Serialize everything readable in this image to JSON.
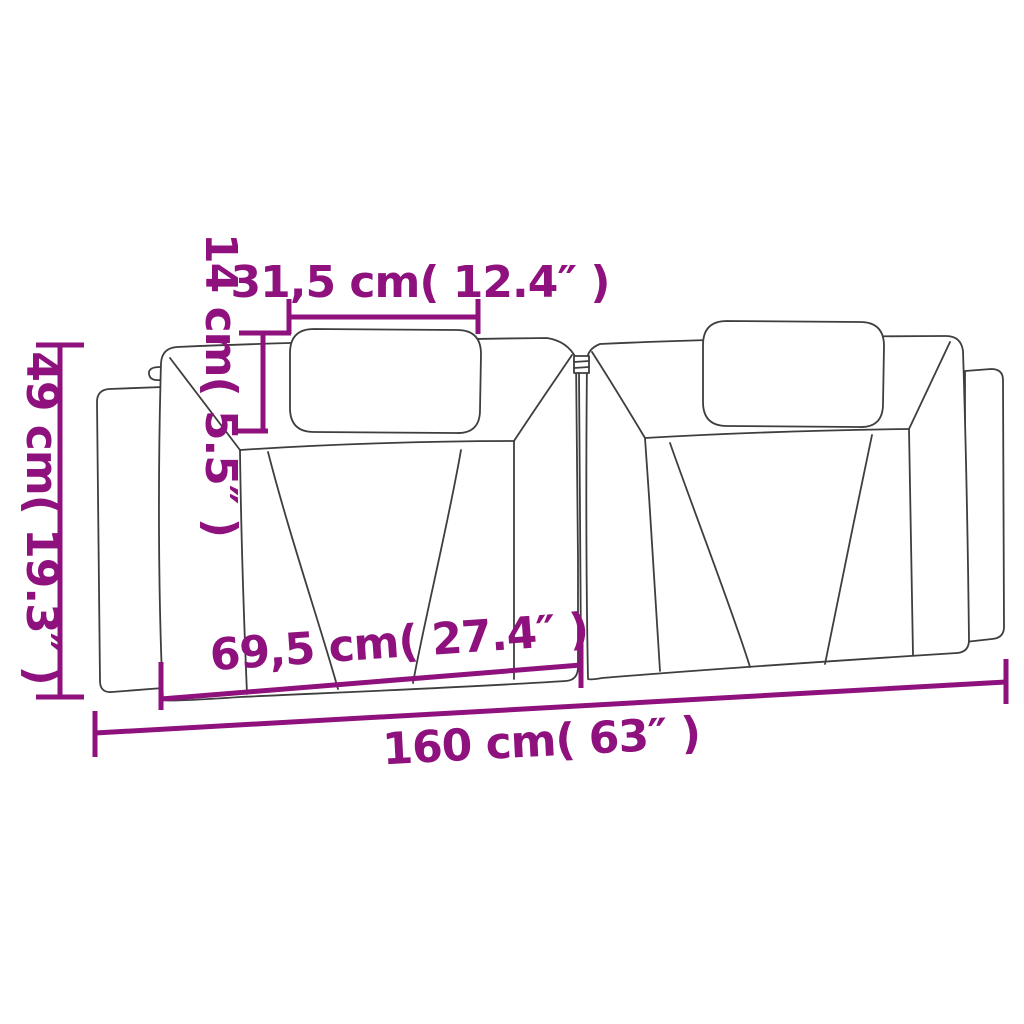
{
  "colors": {
    "accent": "#8E117D",
    "line": "#3E3E3E",
    "bg": "#FFFFFF"
  },
  "dimensions": {
    "pillow_width": {
      "cm": "31,5",
      "inch": "12.4",
      "label": "31,5 cm( 12.4″ )"
    },
    "pillow_height": {
      "cm": "14",
      "inch": "5.5",
      "label": "14 cm( 5.5″ )"
    },
    "cushion_height": {
      "cm": "49",
      "inch": "19.3",
      "label": "49 cm( 19.3″ )"
    },
    "section_width": {
      "cm": "69,5",
      "inch": "27.4",
      "label": "69,5 cm( 27.4″ )"
    },
    "total_width": {
      "cm": "160",
      "inch": "63",
      "label": "160 cm( 63″ )"
    }
  }
}
